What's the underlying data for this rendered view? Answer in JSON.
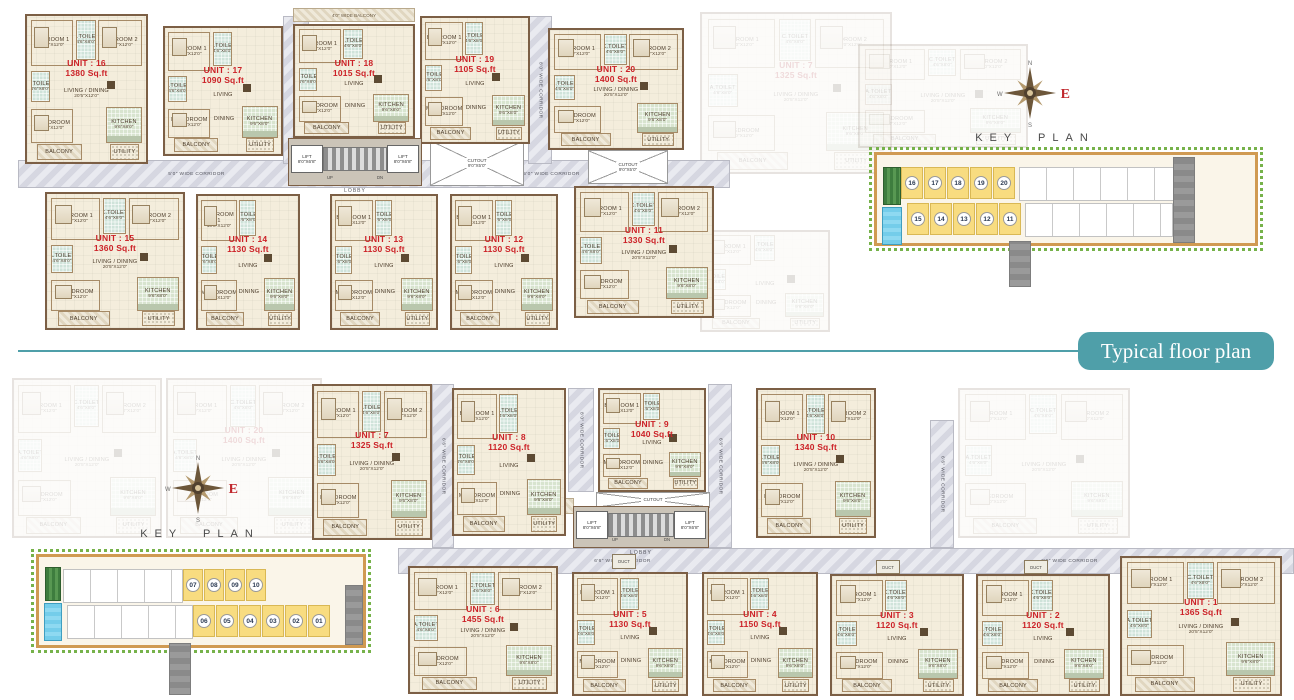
{
  "page": {
    "banner_text": "Typical floor plan"
  },
  "keyplan": {
    "title": "KEY PLAN",
    "compass": {
      "n": "N",
      "e": "E",
      "s": "S",
      "w": "W"
    }
  },
  "keyplan_top": {
    "rows": [
      [
        "16",
        "17",
        "18",
        "19",
        "20"
      ],
      [
        "15",
        "14",
        "13",
        "12",
        "11"
      ]
    ]
  },
  "keyplan_bottom": {
    "rows": [
      [
        "07",
        "08",
        "09",
        "10"
      ],
      [
        "06",
        "05",
        "04",
        "03",
        "02",
        "01"
      ]
    ]
  },
  "labels": {
    "corridor_50": "5'0\" WIDE CORRIDOR",
    "corridor_66": "6'6\" WIDE CORRIDOR",
    "corridor_80": "8'0\" WIDE CORRIDOR",
    "wide_balcony": "4'0\" WIDE BALCONY",
    "lobby": "LOBBY",
    "up": "UP",
    "dn": "DN",
    "lift": "LIFT",
    "lift_dim": "8'0\"X6'8\"",
    "cutout": "CUTOUT",
    "cutout_dim": "9'0\"X5'0\"",
    "duct": "DUCT",
    "utility_balcony": "UTILITY/BALCONY",
    "utility_balcony_dim": "9'0\"X4'0\""
  },
  "rooms": {
    "bed1": {
      "name": "BEDROOM 1",
      "dim": "10'0\"X12'0\""
    },
    "bed2": {
      "name": "BEDROOM 2",
      "dim": "10'0\"X12'0\""
    },
    "mbed": {
      "name": "M.BEDROOM",
      "dim": "11'0\"X12'0\""
    },
    "living_dining": {
      "name": "LIVING / DINING",
      "dim": "20'5\"X12'0\""
    },
    "living": {
      "name": "LIVING",
      "dim": ""
    },
    "dining": {
      "name": "DINING",
      "dim": ""
    },
    "kitchen": {
      "name": "KITCHEN",
      "dim": "9'6\"X8'0\""
    },
    "atoilet": {
      "name": "A.TOILET",
      "dim": "4'6\"X8'0\""
    },
    "ctoilet": {
      "name": "C.TOILET",
      "dim": "4'6\"X8'0\""
    },
    "balcony": {
      "name": "BALCONY"
    },
    "utility": {
      "name": "UTILITY"
    }
  },
  "colors": {
    "accent_teal": "#4f9fa9",
    "unit_label_red": "#cc2127",
    "keyplan_yellow": "#f8dc80",
    "floor_cream": "#f4eddc",
    "wall_brown": "#7c5f45",
    "toilet_green": "#cfe3da",
    "corridor_gray": "#dcdde4",
    "site_border_tan": "#d09a52",
    "tree_green": "#76b24a",
    "lawn_green": "#3e7d3e",
    "pool_blue": "#74cdea"
  },
  "units": [
    {
      "label": "UNIT : 16",
      "area": "1380 Sq.ft",
      "variant": "large",
      "x": 25,
      "y": 14,
      "w": 123,
      "h": 150
    },
    {
      "label": "UNIT : 17",
      "area": "1090 Sq.ft",
      "variant": "small",
      "x": 163,
      "y": 26,
      "w": 120,
      "h": 130
    },
    {
      "label": "UNIT : 18",
      "area": "1015 Sq.ft",
      "variant": "small",
      "x": 293,
      "y": 24,
      "w": 122,
      "h": 114
    },
    {
      "label": "UNIT : 19",
      "area": "1105 Sq.ft",
      "variant": "small",
      "x": 420,
      "y": 16,
      "w": 110,
      "h": 128
    },
    {
      "label": "UNIT : 20",
      "area": "1400 Sq.ft",
      "variant": "large",
      "x": 548,
      "y": 28,
      "w": 136,
      "h": 122
    },
    {
      "label": "UNIT : 15",
      "area": "1360 Sq.ft",
      "variant": "large",
      "x": 45,
      "y": 192,
      "w": 140,
      "h": 138
    },
    {
      "label": "UNIT : 14",
      "area": "1130 Sq.ft",
      "variant": "small",
      "x": 196,
      "y": 194,
      "w": 104,
      "h": 136
    },
    {
      "label": "UNIT : 13",
      "area": "1130 Sq.ft",
      "variant": "small",
      "x": 330,
      "y": 194,
      "w": 108,
      "h": 136
    },
    {
      "label": "UNIT : 12",
      "area": "1130 Sq.ft",
      "variant": "small",
      "x": 450,
      "y": 194,
      "w": 108,
      "h": 136
    },
    {
      "label": "UNIT : 11",
      "area": "1330 Sq.ft",
      "variant": "large",
      "x": 574,
      "y": 186,
      "w": 140,
      "h": 132
    },
    {
      "label": "UNIT : 7",
      "area": "1325 Sq.ft",
      "variant": "large",
      "x": 312,
      "y": 384,
      "w": 120,
      "h": 156
    },
    {
      "label": "UNIT : 8",
      "area": "1120 Sq.ft",
      "variant": "small",
      "x": 452,
      "y": 388,
      "w": 114,
      "h": 148
    },
    {
      "label": "UNIT : 9",
      "area": "1040 Sq.ft",
      "variant": "small",
      "x": 598,
      "y": 388,
      "w": 108,
      "h": 104
    },
    {
      "label": "UNIT : 10",
      "area": "1340 Sq.ft",
      "variant": "large",
      "x": 756,
      "y": 388,
      "w": 120,
      "h": 150
    },
    {
      "label": "UNIT : 6",
      "area": "1455 Sq.ft",
      "variant": "large",
      "x": 408,
      "y": 566,
      "w": 150,
      "h": 128
    },
    {
      "label": "UNIT : 5",
      "area": "1130 Sq.ft",
      "variant": "small",
      "x": 572,
      "y": 572,
      "w": 116,
      "h": 124
    },
    {
      "label": "UNIT : 4",
      "area": "1150 Sq.ft",
      "variant": "small",
      "x": 702,
      "y": 572,
      "w": 116,
      "h": 124
    },
    {
      "label": "UNIT : 3",
      "area": "1120 Sq.ft",
      "variant": "small",
      "x": 830,
      "y": 574,
      "w": 134,
      "h": 122
    },
    {
      "label": "UNIT : 2",
      "area": "1120 Sq.ft",
      "variant": "small",
      "x": 976,
      "y": 574,
      "w": 134,
      "h": 122
    },
    {
      "label": "UNIT : 1",
      "area": "1365 Sq.ft",
      "variant": "large",
      "x": 1120,
      "y": 556,
      "w": 162,
      "h": 140
    },
    {
      "label": "UNIT : 7",
      "area": "1325 Sq.ft",
      "variant": "large",
      "ghost": true,
      "x": 700,
      "y": 12,
      "w": 192,
      "h": 162
    },
    {
      "label": "",
      "area": "",
      "variant": "large",
      "ghost": true,
      "x": 858,
      "y": 44,
      "w": 170,
      "h": 104
    },
    {
      "label": "",
      "area": "",
      "variant": "small",
      "ghost": true,
      "x": 700,
      "y": 230,
      "w": 130,
      "h": 102
    },
    {
      "label": "",
      "area": "",
      "variant": "large",
      "ghost": true,
      "x": 12,
      "y": 378,
      "w": 150,
      "h": 160
    },
    {
      "label": "UNIT : 20",
      "area": "1400 Sq.ft",
      "variant": "large",
      "ghost": true,
      "x": 166,
      "y": 378,
      "w": 156,
      "h": 160
    },
    {
      "label": "",
      "area": "",
      "variant": "large",
      "ghost": true,
      "x": 958,
      "y": 388,
      "w": 172,
      "h": 150
    }
  ]
}
